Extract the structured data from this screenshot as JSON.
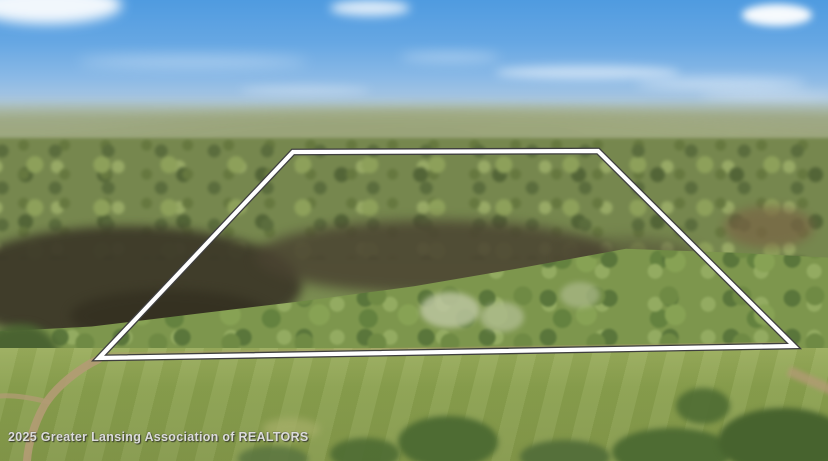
{
  "watermark": {
    "text": "2025 Greater Lansing Association of REALTORS"
  },
  "boundary": {
    "points": "293,152 598,151 794,346 99,358"
  },
  "palette": {
    "sky_top": "#4f9be0",
    "sky_low": "#c9d3c4",
    "far_forest": "#9aa671",
    "mid_forest": "#76874e",
    "marsh_dark": "#3c3828",
    "front_forest": "#7d964d",
    "field_green": "#8aa04e",
    "road_tan": "#b29b74",
    "boundary_line": "#ffffff",
    "boundary_outline": "#3f3f3f",
    "watermark_color": "#dcdcdc"
  }
}
